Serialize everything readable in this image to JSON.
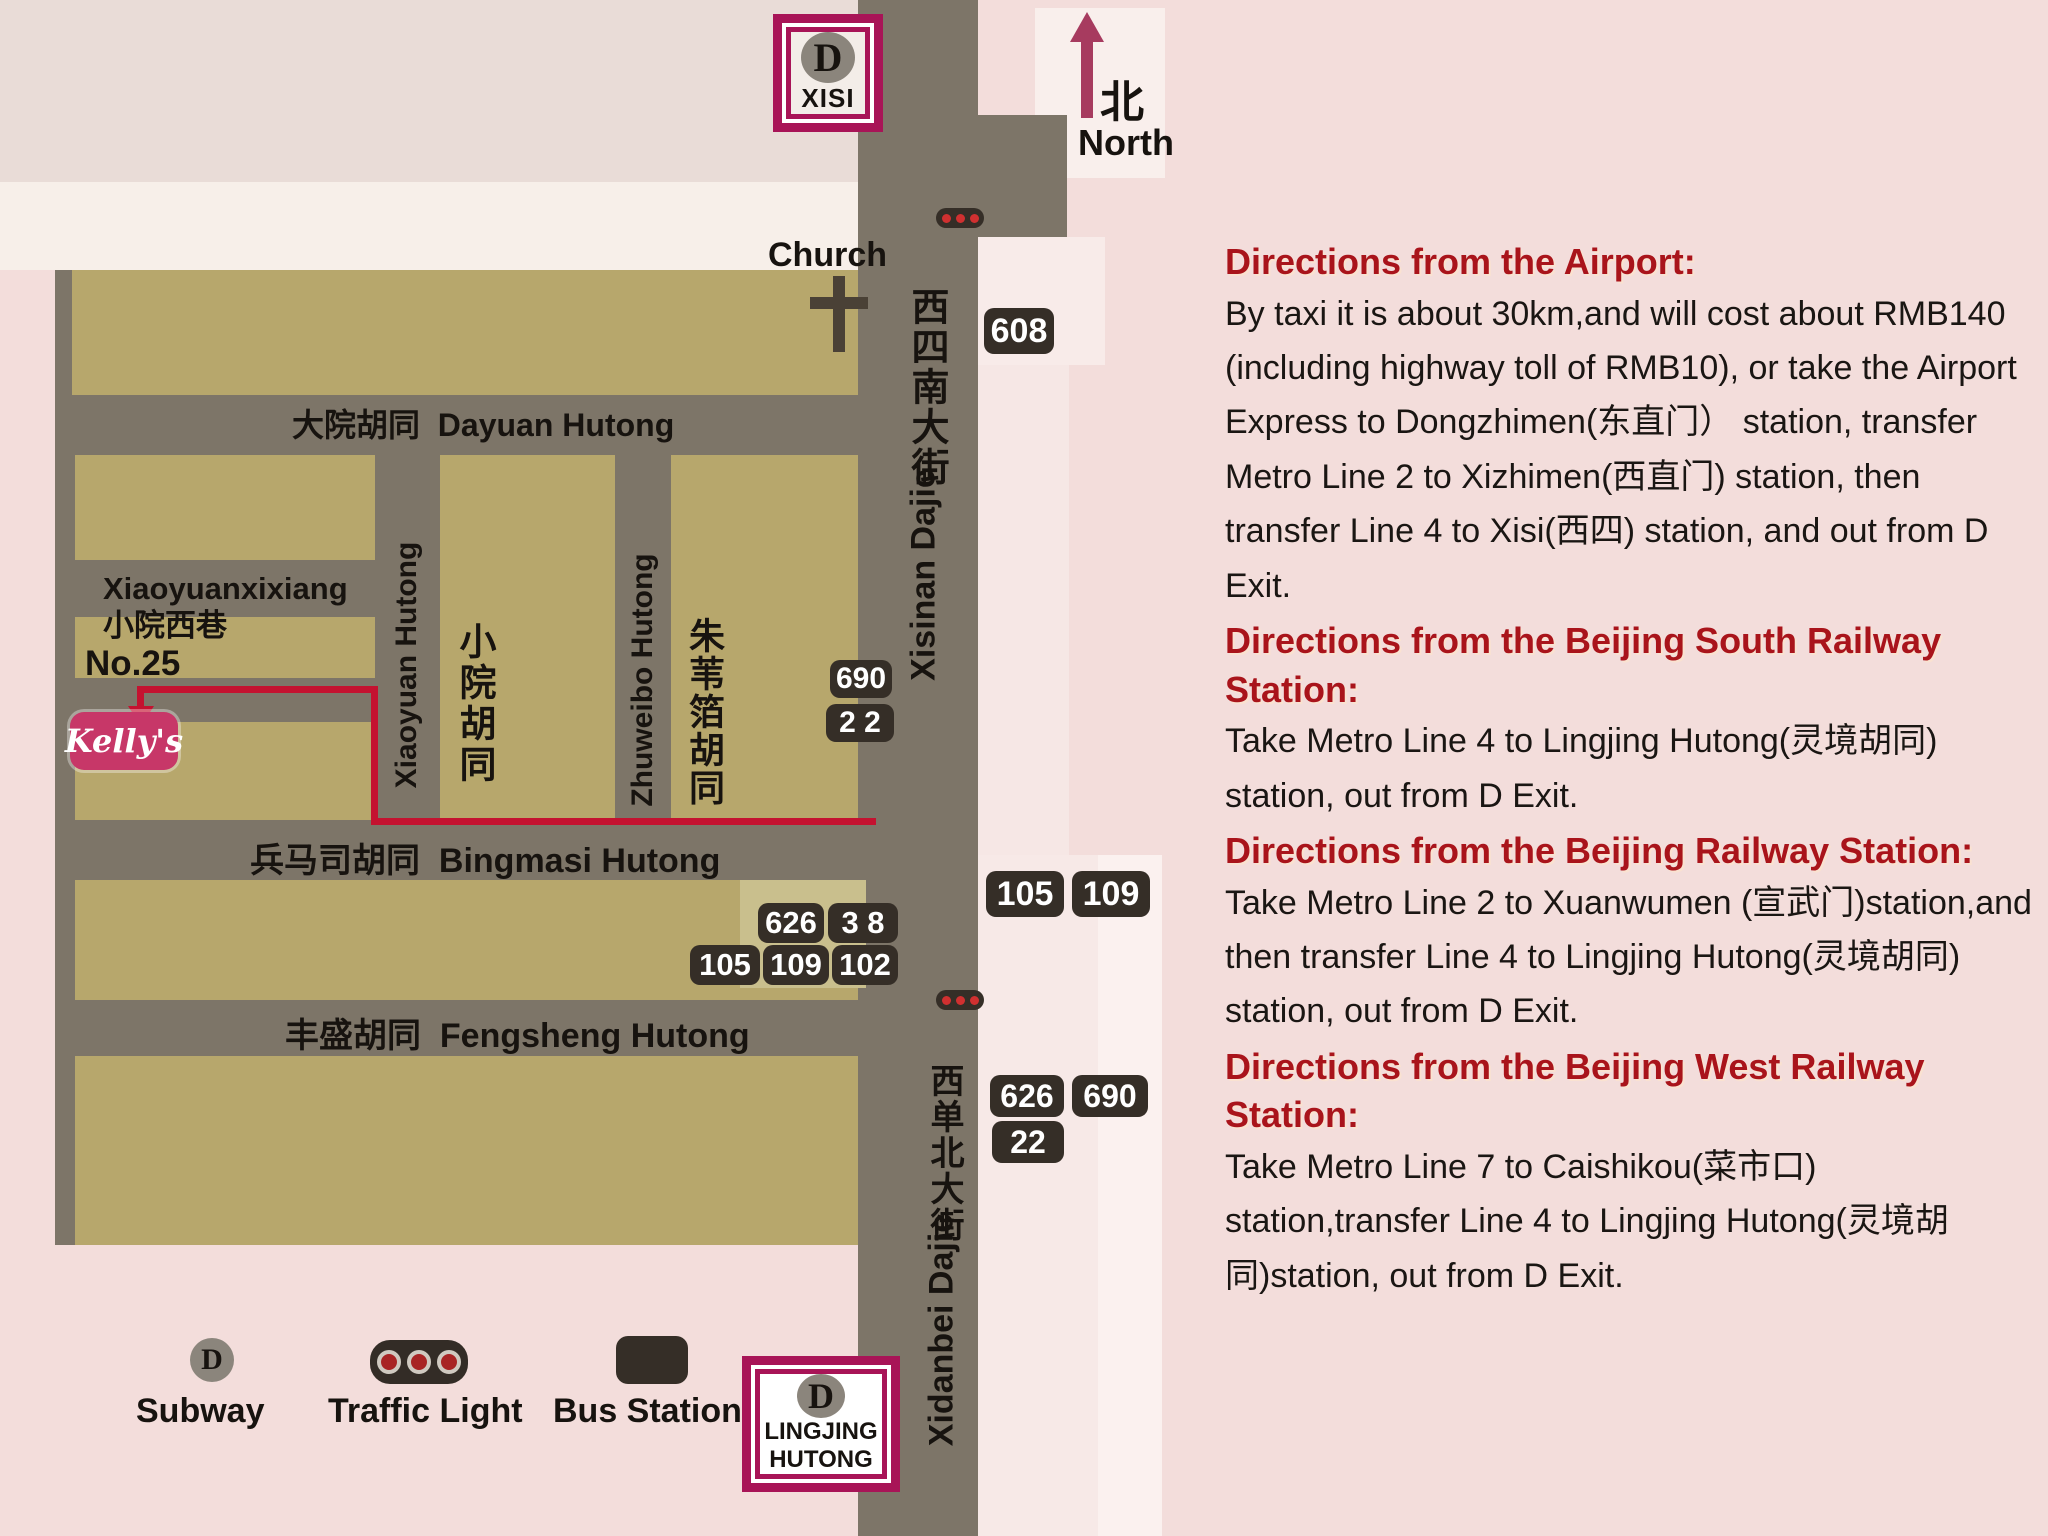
{
  "colors": {
    "page_bg": "#f3dddb",
    "topleft_bg": "#e9dcd7",
    "white_band": "#f7efe9",
    "block_tan": "#b7a76c",
    "block_olive": "#c9bf8d",
    "road_grey": "#7d7568",
    "light_strip": "#f7e9e7",
    "light_strip_bright": "#fbf1ef",
    "badge_dark": "#352e27",
    "station_box_magenta": "#a81457",
    "route_red": "#c41230",
    "north_arrow_magenta": "#a73b5f",
    "kellys_pink": "#c73768",
    "heading_red": "#a9141b",
    "subway_circle_grey": "#8b857c",
    "traffic_light_red": "#d03030"
  },
  "map": {
    "north": {
      "zh": "北",
      "en": "North"
    },
    "church": "Church",
    "xisi_station": {
      "letter": "D",
      "name": "XISI"
    },
    "lingjing_station": {
      "letter": "D",
      "line1": "LINGJING",
      "line2": "HUTONG"
    },
    "streets": {
      "dayuan_zh": "大院胡同",
      "dayuan_en": "Dayuan Hutong",
      "bingmasi_zh": "兵马司胡同",
      "bingmasi_en": "Bingmasi Hutong",
      "fengsheng_zh": "丰盛胡同",
      "fengsheng_en": "Fengsheng Hutong",
      "xiaoyuanxixiang_en": "Xiaoyuanxixiang",
      "xiaoyuanxixiang_zh": "小院西巷",
      "xiaoyuan_en": "Xiaoyuan Hutong",
      "xiaoyuan_zh": "小院胡同",
      "zhuweibo_en": "Zhuweibo Hutong",
      "zhuweibo_zh": "朱苇箔胡同",
      "xisinan_zh": "西四南大街",
      "xisinan_en": "Xisinan Dajie",
      "xidanbei_zh": "西单北大街",
      "xidanbei_en": "Xidanbei Dajie"
    },
    "poi": {
      "house_no": "No.25",
      "kellys": "Kelly's"
    },
    "bus_badges": {
      "b608": "608",
      "b690_road": "690",
      "b22_road": "2 2",
      "b626_stop": "626",
      "b38_stop": "3 8",
      "b105_stop": "105",
      "b109_stop": "109",
      "b102_stop": "102",
      "b105_right": "105",
      "b109_right": "109",
      "b626_lower": "626",
      "b690_lower": "690",
      "b22_lower": "22"
    },
    "legend": {
      "subway_letter": "D",
      "subway": "Subway",
      "traffic_light": "Traffic Light",
      "bus_station": "Bus Station"
    }
  },
  "directions": [
    {
      "heading": "Directions from the Airport:",
      "body": "By taxi it is about 30km,and will cost about RMB140 (including highway toll of RMB10), or take the Airport Express to Dongzhimen(东直门） station, transfer Metro Line 2 to Xizhimen(西直门) station, then transfer Line 4 to Xisi(西四) station, and out from D Exit."
    },
    {
      "heading": "Directions from the Beijing South Railway Station:",
      "body": "Take Metro Line 4 to Lingjing Hutong(灵境胡同) station, out from D Exit."
    },
    {
      "heading": "Directions from the Beijing Railway Station:",
      "body": "Take Metro Line 2 to Xuanwumen (宣武门)station,and then transfer Line 4 to Lingjing Hutong(灵境胡同) station, out from D Exit."
    },
    {
      "heading": "Directions from the Beijing West Railway Station:",
      "body": "Take Metro Line 7 to Caishikou(菜市口) station,transfer Line 4 to Lingjing Hutong(灵境胡同)station, out from D Exit."
    }
  ]
}
